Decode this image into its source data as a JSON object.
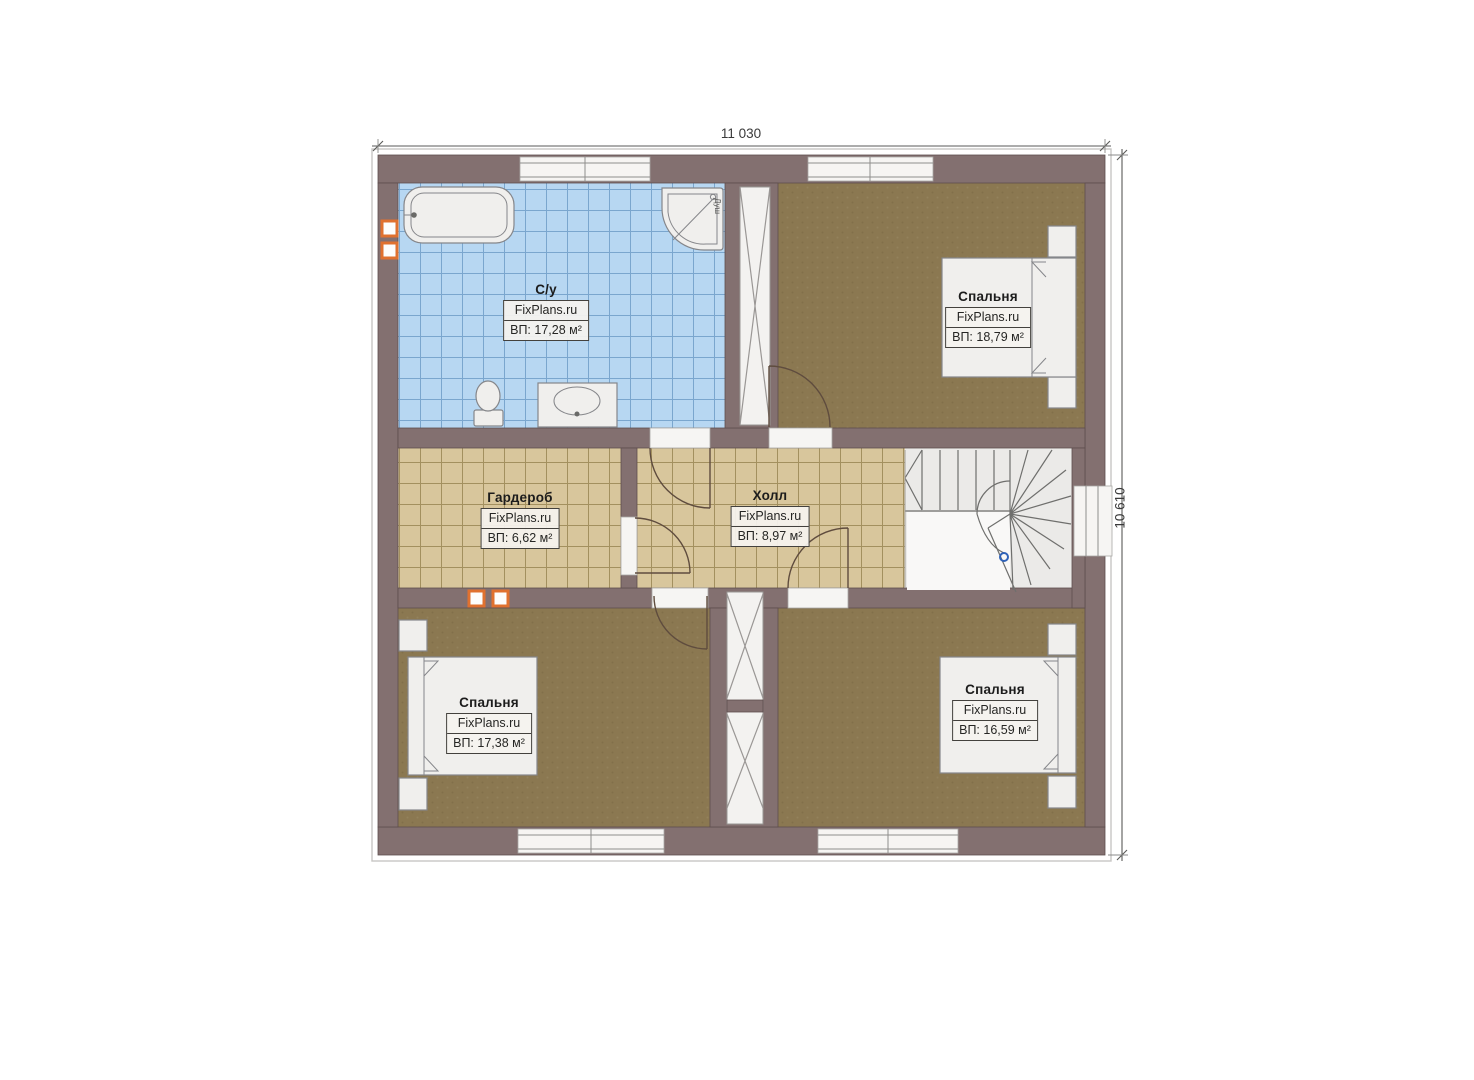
{
  "dimensions": {
    "width_label": "11 030",
    "height_label": "10 610"
  },
  "rooms": [
    {
      "name": "С/у",
      "brand": "FixPlans.ru",
      "area_label": "ВП: 17,28 м²"
    },
    {
      "name": "Спальня",
      "brand": "FixPlans.ru",
      "area_label": "ВП: 18,79 м²"
    },
    {
      "name": "Гардероб",
      "brand": "FixPlans.ru",
      "area_label": "ВП: 6,62 м²"
    },
    {
      "name": "Холл",
      "brand": "FixPlans.ru",
      "area_label": "ВП: 8,97 м²"
    },
    {
      "name": "Спальня",
      "brand": "FixPlans.ru",
      "area_label": "ВП: 17,38 м²"
    },
    {
      "name": "Спальня",
      "brand": "FixPlans.ru",
      "area_label": "ВП: 16,59 м²"
    }
  ],
  "annotations": {
    "shower_label": "Душ"
  },
  "colors": {
    "wall": "#837070",
    "wall-edge": "#5e4e4e",
    "tile-blue": "#b7d7f2",
    "tile-blue-line": "#7aa6ce",
    "tile-tan": "#d8c69c",
    "tile-tan-line": "#a3905f",
    "carpet": "#8b7851",
    "accent-orange": "#e0712f",
    "marker-blue": "#2f62b8"
  }
}
